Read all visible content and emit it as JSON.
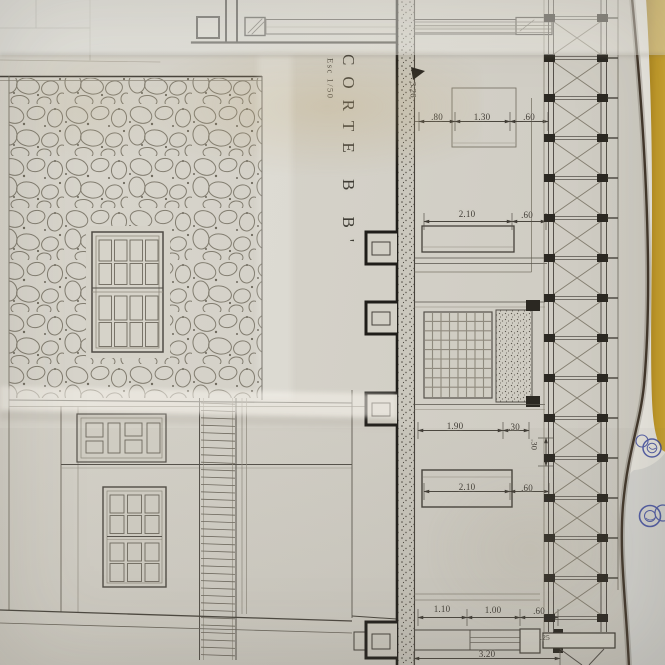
{
  "drawing": {
    "title": "CORTE B B'",
    "scale_label": "Esc 1/50",
    "dims": {
      "height_326": "3.26",
      "top_80": ".80",
      "top_130": "1.30",
      "top_60": ".60",
      "upper_210": "2.10",
      "upper_60": ".60",
      "mid_190": "1.90",
      "mid_30": ".30",
      "col_30": ".30",
      "low_210": "2.10",
      "low_60": ".60",
      "bot_110": "1.10",
      "bot_100": "1.00",
      "bot_60": ".60",
      "bot_25": ".25",
      "bot_total": "3.20"
    },
    "colors": {
      "paper": "#d4d1c8",
      "ink": "#45413a",
      "table_yellow": "#c9a02a",
      "stamp_blue": "#31409c"
    }
  }
}
